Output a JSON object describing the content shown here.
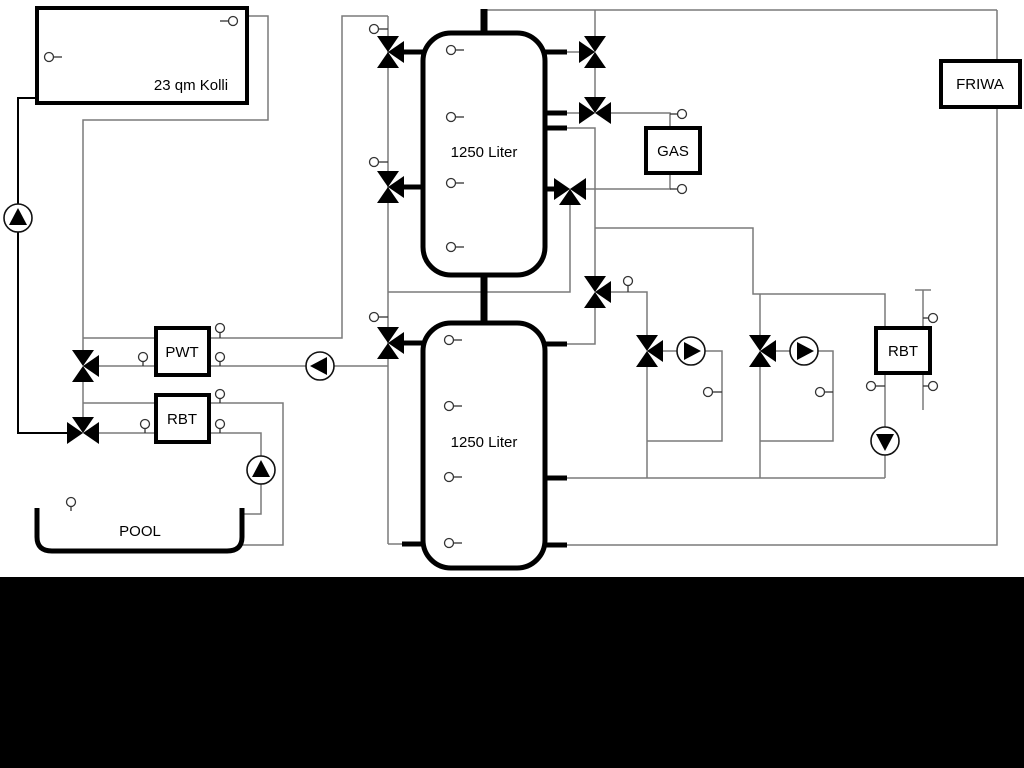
{
  "diagram": {
    "title": "heating-solar-hydraulic-schematic",
    "labels": {
      "collector": "23 qm Kolli",
      "tank_top": "1250 Liter",
      "tank_bottom": "1250 Liter",
      "gas": "GAS",
      "friwa": "FRIWA",
      "pwt": "PWT",
      "rbt_left": "RBT",
      "rbt_right": "RBT",
      "pool": "POOL"
    },
    "colors": {
      "background": "#ffffff",
      "pipe_gray": "#7a7a7a",
      "pipe_black": "#000000",
      "component_stroke": "#111111",
      "bottom_band": "#000000"
    },
    "component_icons": {
      "pump": "circle-with-solid-triangle",
      "three_way_valve": "three-white-triangles",
      "sensor": "small-circle-with-stem"
    }
  }
}
